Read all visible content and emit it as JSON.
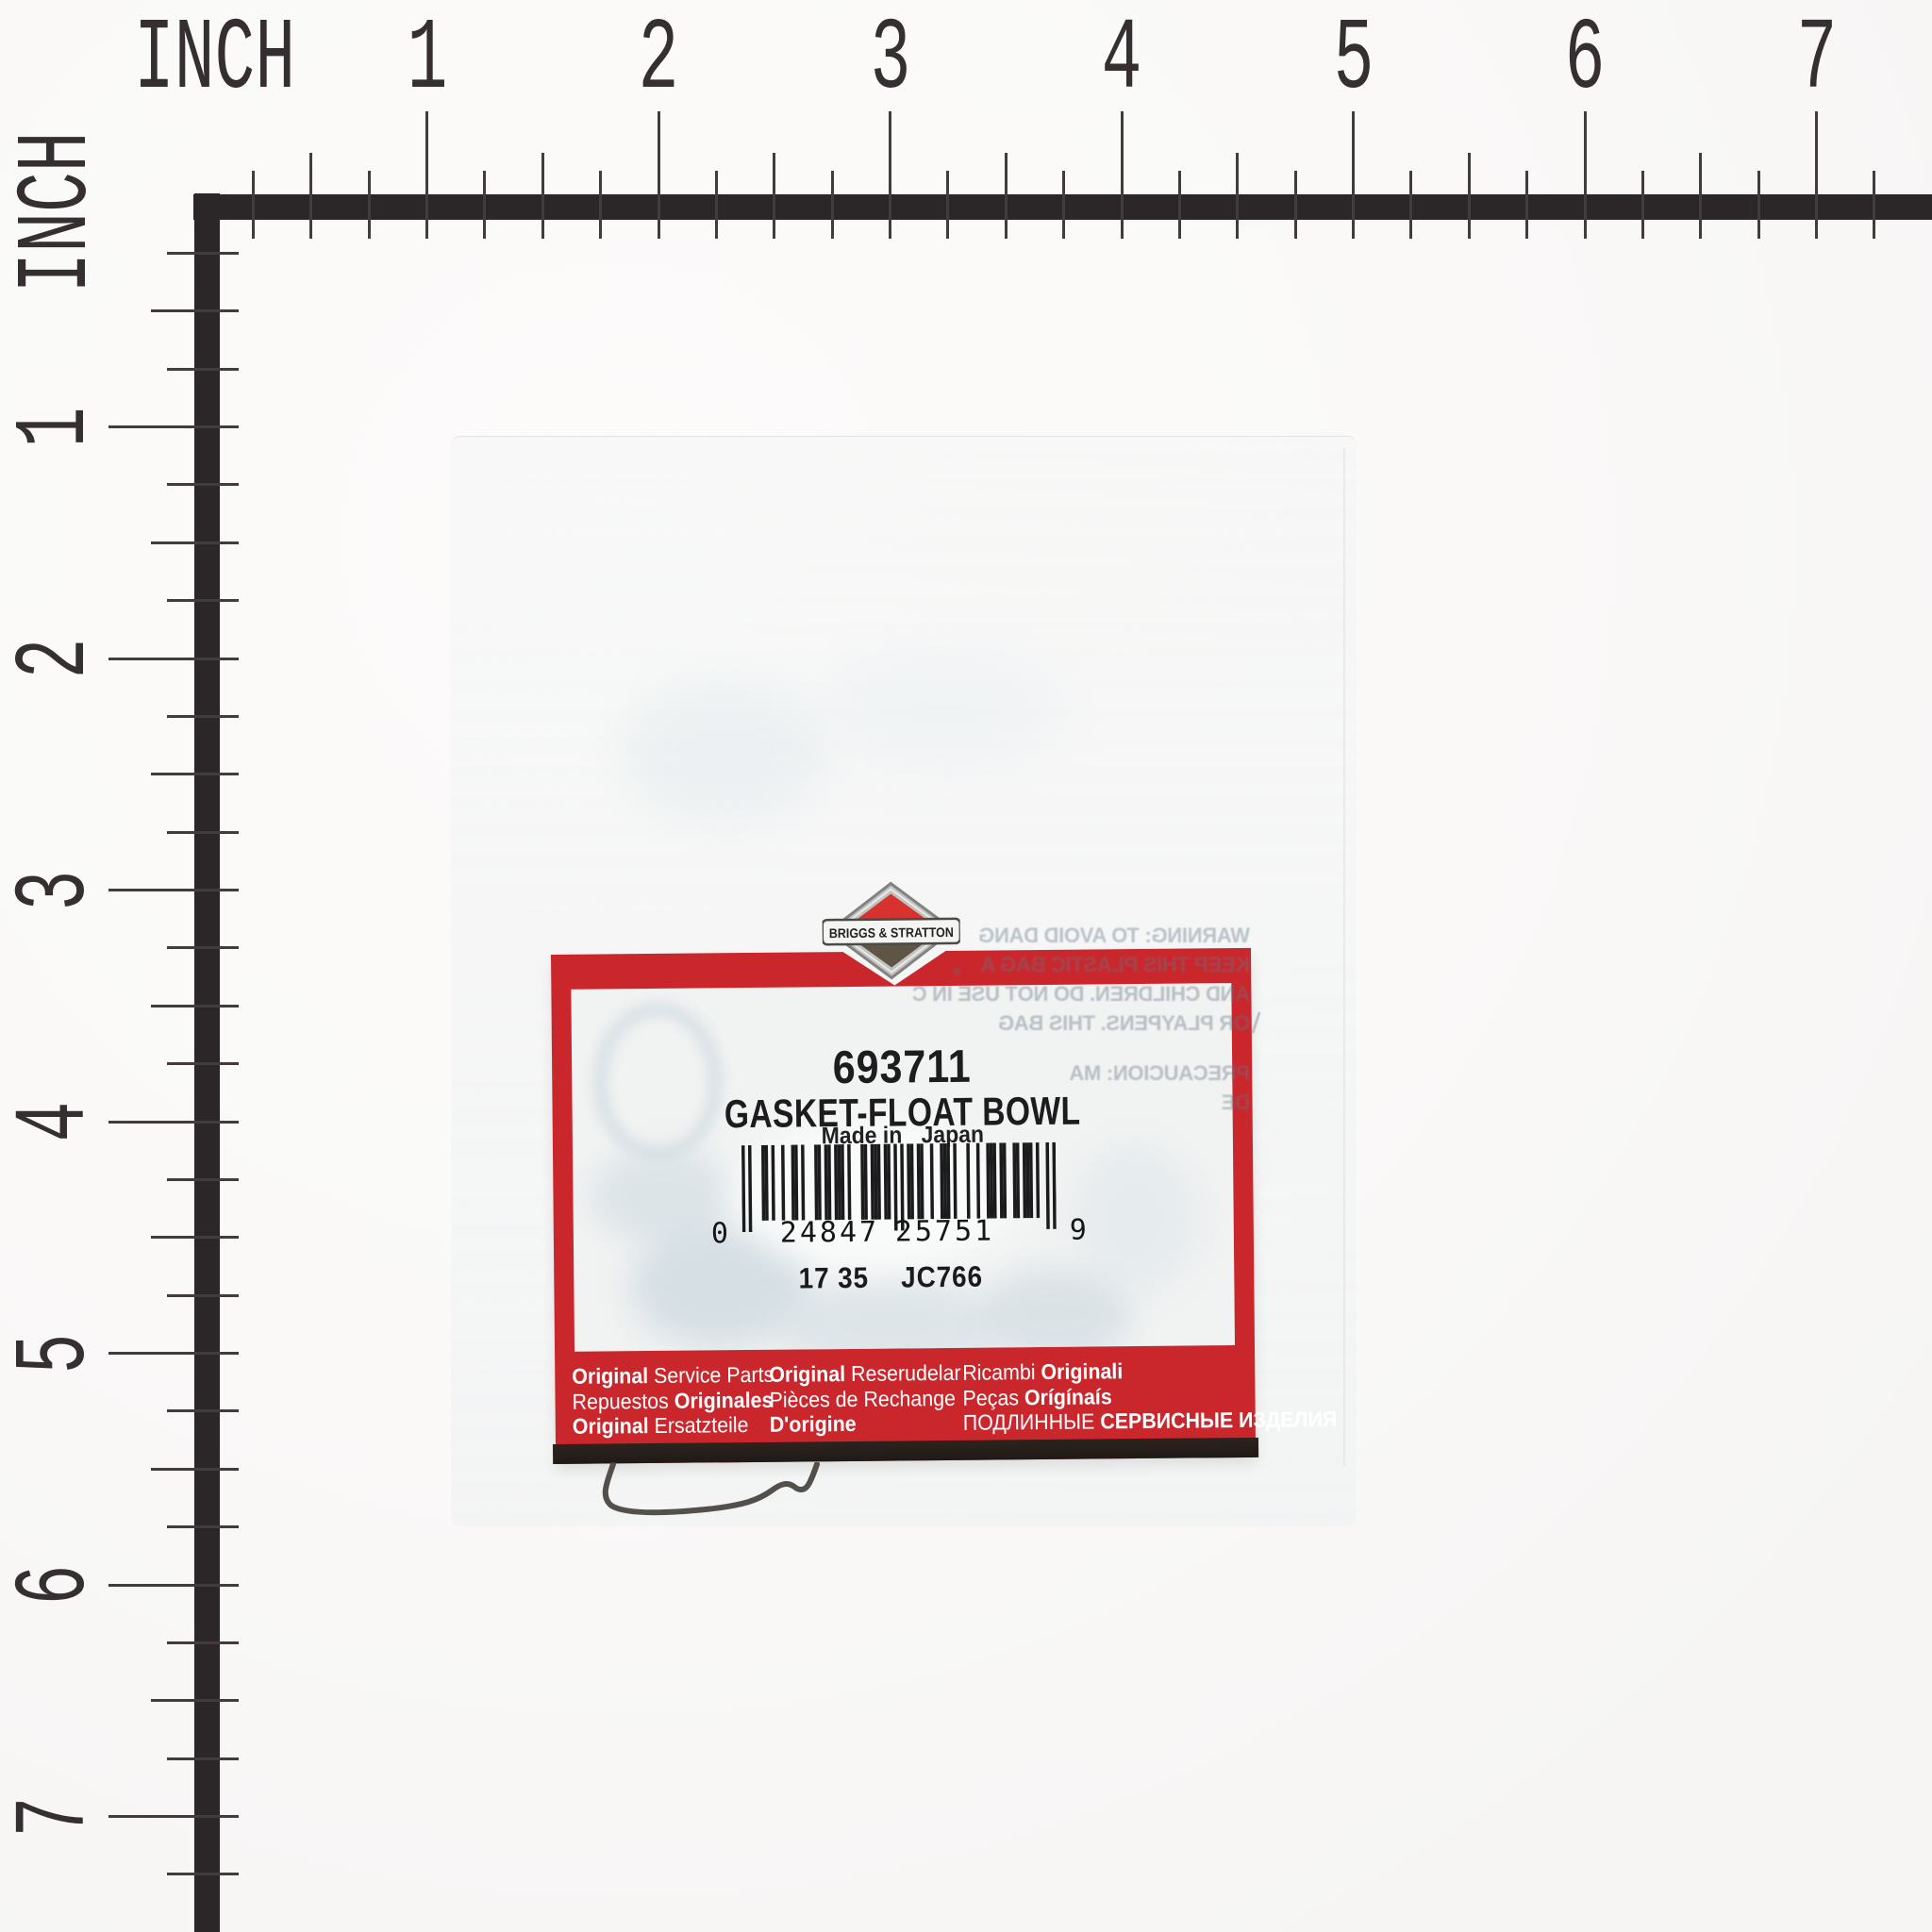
{
  "ruler": {
    "unit_label": "INCH",
    "numbers": [
      "1",
      "2",
      "3",
      "4",
      "5",
      "6",
      "7"
    ]
  },
  "label": {
    "part_number": "693711",
    "part_name": "GASKET-FLOAT BOWL",
    "made_in_prefix": "Made in",
    "made_in_country": "Japan",
    "barcode": {
      "value": "024847257519",
      "human": [
        "0",
        "24847",
        "25751",
        "9"
      ]
    },
    "codes": [
      "17 35",
      "JC766"
    ],
    "footer_columns": [
      [
        [
          [
            "Original",
            1
          ],
          [
            " Service Parts",
            0
          ]
        ],
        [
          [
            "Repuestos ",
            0
          ],
          [
            "Originales",
            1
          ]
        ],
        [
          [
            "Original",
            1
          ],
          [
            " Ersatzteile",
            0
          ]
        ]
      ],
      [
        [
          [
            "Original",
            1
          ],
          [
            " Reserudelar",
            0
          ]
        ],
        [
          [
            "Pièces de Rechange",
            0
          ]
        ],
        [
          [
            "D'origine",
            1
          ]
        ]
      ],
      [
        [
          [
            "Ricambi ",
            0
          ],
          [
            "Originali",
            1
          ]
        ],
        [
          [
            "Peças ",
            0
          ],
          [
            "Orígínaís",
            1
          ]
        ],
        [
          [
            "ПОДЛИННЫЕ ",
            0
          ],
          [
            "СЕРВИСНЫЕ ИЗДЕЛИЯ",
            1
          ]
        ]
      ]
    ]
  },
  "logo": {
    "brand": "BRIGGS & STRATTON",
    "registered_mark": "®"
  },
  "bag_back_text": [
    "WARNING: TO AVOID DANG",
    "KEEP THIS PLASTIC BAG A",
    "AND CHILDREN. DO NOT USE IN C",
    "OR PLAYPENS. THIS BAG",
    "PRECAUCION: MA",
    "DE"
  ],
  "colors": {
    "label_red": "#ca272d",
    "ruler_black": "#2b2628",
    "strip_brown": "#251e19",
    "bubble_blue": "#ccd8de"
  }
}
